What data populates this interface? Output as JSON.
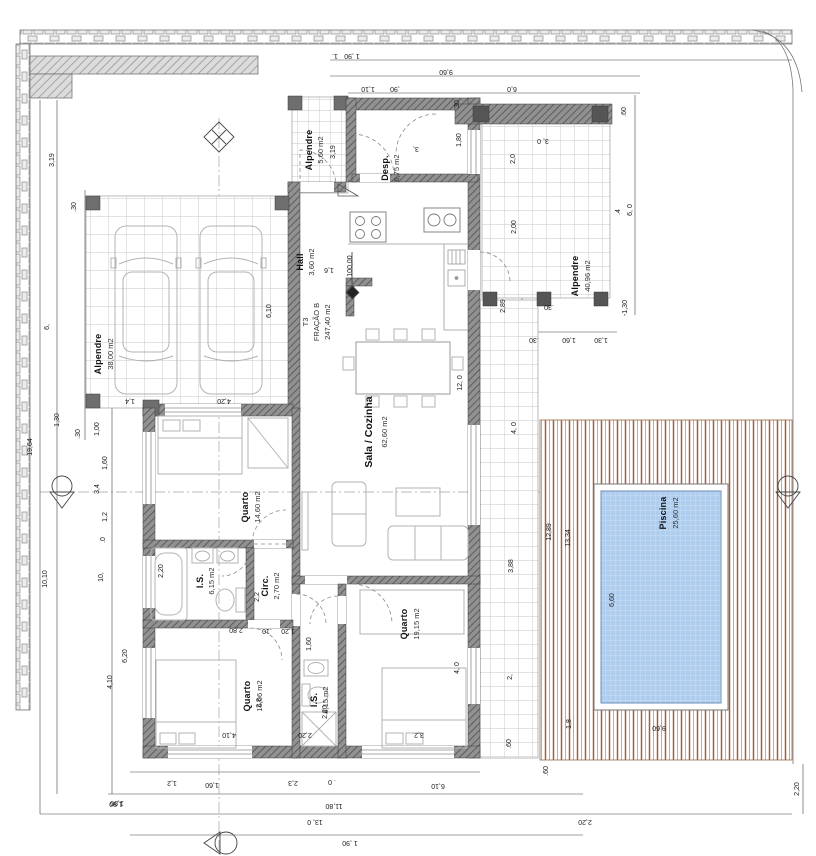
{
  "colors": {
    "wall_base": "#919191",
    "wall_hatch": "#575757",
    "deck_stripe": "#a85c30",
    "deck_stripe_light": "#cf9a6c",
    "pool_water": "#aecdef",
    "pool_grid": "#d3e4f8",
    "tile_line": "#c6c6c6",
    "brick_fill": "#ececec",
    "brick_line": "#8a8a8a"
  },
  "labels": [
    {
      "name": "room-alpendre-top-name",
      "text": "Alpendre",
      "x": 312,
      "y": 150,
      "rot": -90,
      "kind": "room"
    },
    {
      "name": "room-alpendre-top-area",
      "text": "5,60 m2",
      "x": 323,
      "y": 150,
      "rot": -90,
      "kind": "area"
    },
    {
      "name": "dim-alpendre-top",
      "text": "3,19",
      "x": 335,
      "y": 152,
      "rot": -90,
      "kind": "dim"
    },
    {
      "name": "room-desp-name",
      "text": "Desp.",
      "x": 388,
      "y": 168,
      "rot": -90,
      "kind": "room"
    },
    {
      "name": "room-desp-area",
      "text": "6,75 m2",
      "x": 399,
      "y": 168,
      "rot": -90,
      "kind": "area"
    },
    {
      "name": "room-hall-name",
      "text": "Hall",
      "x": 303,
      "y": 262,
      "rot": -90,
      "kind": "room"
    },
    {
      "name": "room-hall-area",
      "text": "3,60 m2",
      "x": 314,
      "y": 262,
      "rot": -90,
      "kind": "area"
    },
    {
      "name": "title-fraction-line1",
      "text": "T3",
      "x": 308,
      "y": 322,
      "rot": -90,
      "kind": "area"
    },
    {
      "name": "title-fraction-line2",
      "text": "FRAÇÃO B",
      "x": 319,
      "y": 322,
      "rot": -90,
      "kind": "area"
    },
    {
      "name": "title-fraction-line3",
      "text": "247,40 m2",
      "x": 330,
      "y": 322,
      "rot": -90,
      "kind": "area"
    },
    {
      "name": "room-sala-name",
      "text": "Sala / Cozinha",
      "x": 372,
      "y": 432,
      "rot": -90,
      "kind": "roomBig"
    },
    {
      "name": "room-sala-area",
      "text": "62,60 m2",
      "x": 387,
      "y": 432,
      "rot": -90,
      "kind": "area"
    },
    {
      "name": "room-garage-name",
      "text": "Alpendre",
      "x": 101,
      "y": 354,
      "rot": -90,
      "kind": "room"
    },
    {
      "name": "room-garage-area",
      "text": "38,00 m2",
      "x": 113,
      "y": 354,
      "rot": -90,
      "kind": "area"
    },
    {
      "name": "room-rporch-name",
      "text": "Alpendre",
      "x": 578,
      "y": 276,
      "rot": -90,
      "kind": "room"
    },
    {
      "name": "room-rporch-area",
      "text": "40,96 m2",
      "x": 590,
      "y": 276,
      "rot": -90,
      "kind": "area"
    },
    {
      "name": "room-quarto1-name",
      "text": "Quarto",
      "x": 248,
      "y": 507,
      "rot": -90,
      "kind": "room"
    },
    {
      "name": "room-quarto1-area",
      "text": "14,60 m2",
      "x": 260,
      "y": 507,
      "rot": -90,
      "kind": "area"
    },
    {
      "name": "room-is1-name",
      "text": "I.S.",
      "x": 203,
      "y": 581,
      "rot": -90,
      "kind": "room"
    },
    {
      "name": "room-is1-area",
      "text": "6,15 m2",
      "x": 214,
      "y": 581,
      "rot": -90,
      "kind": "area"
    },
    {
      "name": "room-circ-name",
      "text": "Circ.",
      "x": 268,
      "y": 586,
      "rot": -90,
      "kind": "room"
    },
    {
      "name": "room-circ-area",
      "text": "2,70 m2",
      "x": 279,
      "y": 586,
      "rot": -90,
      "kind": "area"
    },
    {
      "name": "room-quarto2-name",
      "text": "Quarto",
      "x": 250,
      "y": 696,
      "rot": -90,
      "kind": "room"
    },
    {
      "name": "room-quarto2-area",
      "text": "16,06 m2",
      "x": 262,
      "y": 696,
      "rot": -90,
      "kind": "area"
    },
    {
      "name": "room-is2-name",
      "text": "I.S.",
      "x": 317,
      "y": 700,
      "rot": -90,
      "kind": "room"
    },
    {
      "name": "room-is2-area",
      "text": "6,15 m2",
      "x": 328,
      "y": 700,
      "rot": -90,
      "kind": "area"
    },
    {
      "name": "room-quarto3-name",
      "text": "Quarto",
      "x": 407,
      "y": 624,
      "rot": -90,
      "kind": "room"
    },
    {
      "name": "room-quarto3-area",
      "text": "19,15 m2",
      "x": 419,
      "y": 624,
      "rot": -90,
      "kind": "area"
    },
    {
      "name": "room-piscina-name",
      "text": "Piscina",
      "x": 666,
      "y": 513,
      "rot": -90,
      "kind": "room"
    },
    {
      "name": "room-piscina-area",
      "text": "25,60 m2",
      "x": 678,
      "y": 513,
      "rot": -90,
      "kind": "area"
    },
    {
      "name": "level-value",
      "text": "100,00",
      "x": 352,
      "y": 266,
      "rot": -90,
      "kind": "dim"
    },
    {
      "name": "dim-top-1",
      "text": "1.",
      "x": 335,
      "y": 54,
      "rot": 180,
      "kind": "dim"
    },
    {
      "name": "dim-top-190",
      "text": "1 ,90",
      "x": 352,
      "y": 54,
      "rot": 180,
      "kind": "dim"
    },
    {
      "name": "dim-top-960",
      "text": "9,60",
      "x": 446,
      "y": 70,
      "rot": 180,
      "kind": "dim"
    },
    {
      "name": "dim-top-110",
      "text": "1,10",
      "x": 368,
      "y": 87,
      "rot": 180,
      "kind": "dim"
    },
    {
      "name": "dim-top-90",
      "text": ",90",
      "x": 395,
      "y": 87,
      "rot": 180,
      "kind": "dim"
    },
    {
      "name": "dim-top-60",
      "text": "6,0",
      "x": 512,
      "y": 87,
      "rot": 180,
      "kind": "dim"
    },
    {
      "name": "dim-left-319",
      "text": "3,19",
      "x": 54,
      "y": 160,
      "rot": -90,
      "kind": "dim"
    },
    {
      "name": "dim-left-30a",
      "text": ".30",
      "x": 76,
      "y": 207,
      "rot": -90,
      "kind": "dim"
    },
    {
      "name": "dim-left-6",
      "text": "6,",
      "x": 49,
      "y": 327,
      "rot": -90,
      "kind": "dim"
    },
    {
      "name": "dim-left-1964",
      "text": "19,64",
      "x": 32,
      "y": 447,
      "rot": -90,
      "kind": "dim"
    },
    {
      "name": "dim-left-1010",
      "text": "10,10",
      "x": 47,
      "y": 579,
      "rot": -90,
      "kind": "dim"
    },
    {
      "name": "dim-left-10",
      "text": "10,",
      "x": 103,
      "y": 577,
      "rot": -90,
      "kind": "dim"
    },
    {
      "name": "dim-left-130",
      "text": "1,30",
      "x": 59,
      "y": 420,
      "rot": -90,
      "kind": "dim"
    },
    {
      "name": "dim-left-30b",
      "text": ".30",
      "x": 80,
      "y": 434,
      "rot": -90,
      "kind": "dim"
    },
    {
      "name": "dim-left-100",
      "text": "1,00",
      "x": 99,
      "y": 429,
      "rot": -90,
      "kind": "dim"
    },
    {
      "name": "dim-left-160",
      "text": "1,60",
      "x": 107,
      "y": 463,
      "rot": -90,
      "kind": "dim"
    },
    {
      "name": "dim-left-34",
      "text": "3,4",
      "x": 99,
      "y": 489,
      "rot": -90,
      "kind": "dim"
    },
    {
      "name": "dim-left-12",
      "text": "1,2",
      "x": 107,
      "y": 517,
      "rot": -90,
      "kind": "dim"
    },
    {
      "name": "dim-left-0",
      "text": ".0",
      "x": 105,
      "y": 540,
      "rot": -90,
      "kind": "dim"
    },
    {
      "name": "dim-left-620",
      "text": "6,20",
      "x": 127,
      "y": 656,
      "rot": -90,
      "kind": "dim"
    },
    {
      "name": "dim-left-410",
      "text": "4,10",
      "x": 112,
      "y": 682,
      "rot": -90,
      "kind": "dim"
    },
    {
      "name": "dim-left-190",
      "text": "1,90",
      "x": 117,
      "y": 801,
      "rot": 180,
      "kind": "dim"
    },
    {
      "name": "dim-garage-14",
      "text": "1,4",
      "x": 130,
      "y": 399,
      "rot": 180,
      "kind": "dim"
    },
    {
      "name": "dim-garage-420",
      "text": "4,20",
      "x": 224,
      "y": 399,
      "rot": 180,
      "kind": "dim"
    },
    {
      "name": "dim-garage-610",
      "text": "6,10",
      "x": 271,
      "y": 311,
      "rot": -90,
      "kind": "dim"
    },
    {
      "name": "dim-hall-16",
      "text": "1,6",
      "x": 329,
      "y": 268,
      "rot": 180,
      "kind": "dim"
    },
    {
      "name": "dim-sala-120",
      "text": "12, 0",
      "x": 462,
      "y": 383,
      "rot": -90,
      "kind": "dim"
    },
    {
      "name": "dim-desp-180",
      "text": "1,80",
      "x": 461,
      "y": 140,
      "rot": -90,
      "kind": "dim"
    },
    {
      "name": "dim-desp-3",
      "text": "3,",
      "x": 416,
      "y": 147,
      "rot": 180,
      "kind": "dim"
    },
    {
      "name": "dim-tub-220",
      "text": "2,20",
      "x": 163,
      "y": 571,
      "rot": -90,
      "kind": "dim"
    },
    {
      "name": "dim-circ-22",
      "text": "2,2",
      "x": 259,
      "y": 597,
      "rot": -90,
      "kind": "dim"
    },
    {
      "name": "dim-mid-280",
      "text": "2,80",
      "x": 236,
      "y": 628,
      "rot": 180,
      "kind": "dim"
    },
    {
      "name": "dim-mid-10",
      "text": ".10",
      "x": 267,
      "y": 629,
      "rot": 180,
      "kind": "dim"
    },
    {
      "name": "dim-mid-120",
      "text": "1,20",
      "x": 288,
      "y": 629,
      "rot": 180,
      "kind": "dim"
    },
    {
      "name": "dim-q2-28",
      "text": "2,8",
      "x": 261,
      "y": 703,
      "rot": -90,
      "kind": "dim"
    },
    {
      "name": "dim-is2-220",
      "text": "2,20",
      "x": 327,
      "y": 712,
      "rot": -90,
      "kind": "dim"
    },
    {
      "name": "dim-is2-160",
      "text": "1,60",
      "x": 311,
      "y": 644,
      "rot": -90,
      "kind": "dim"
    },
    {
      "name": "dim-bot-410",
      "text": "4,10",
      "x": 229,
      "y": 733,
      "rot": 180,
      "kind": "dim"
    },
    {
      "name": "dim-bot-220",
      "text": "2,20",
      "x": 305,
      "y": 733,
      "rot": 180,
      "kind": "dim"
    },
    {
      "name": "dim-bot-32",
      "text": "3,2",
      "x": 419,
      "y": 733,
      "rot": 180,
      "kind": "dim"
    },
    {
      "name": "dim-q3-40",
      "text": "4, 0",
      "x": 459,
      "y": 668,
      "rot": -90,
      "kind": "dim"
    },
    {
      "name": "dim-wing-30a",
      "text": ".30",
      "x": 459,
      "y": 105,
      "rot": -90,
      "kind": "dim"
    },
    {
      "name": "dim-wing-30b",
      "text": "3, 0",
      "x": 543,
      "y": 139,
      "rot": 180,
      "kind": "dim"
    },
    {
      "name": "dim-wing-20",
      "text": "2,0",
      "x": 515,
      "y": 159,
      "rot": -90,
      "kind": "dim"
    },
    {
      "name": "dim-wing-200",
      "text": "2,00",
      "x": 516,
      "y": 227,
      "rot": -90,
      "kind": "dim"
    },
    {
      "name": "dim-wing-289",
      "text": "2,89",
      "x": 505,
      "y": 306,
      "rot": -90,
      "kind": "dim"
    },
    {
      "name": "dim-wing-30c",
      "text": ".30",
      "x": 549,
      "y": 305,
      "rot": 180,
      "kind": "dim"
    },
    {
      "name": "dim-wing-60a",
      "text": ".60",
      "x": 626,
      "y": 112,
      "rot": -90,
      "kind": "dim"
    },
    {
      "name": "dim-wing-6_0",
      "text": "6, 0",
      "x": 632,
      "y": 210,
      "rot": -90,
      "kind": "dim"
    },
    {
      "name": "dim-wing-4",
      "text": ".4",
      "x": 620,
      "y": 212,
      "rot": -90,
      "kind": "dim"
    },
    {
      "name": "dim-wing-m130",
      "text": "-1,30",
      "x": 627,
      "y": 308,
      "rot": -90,
      "kind": "dim"
    },
    {
      "name": "dim-row-30",
      "text": ".30",
      "x": 534,
      "y": 338,
      "rot": 180,
      "kind": "dim"
    },
    {
      "name": "dim-row-160",
      "text": "1,60",
      "x": 569,
      "y": 338,
      "rot": 180,
      "kind": "dim"
    },
    {
      "name": "dim-row-130",
      "text": "1,30",
      "x": 601,
      "y": 338,
      "rot": 180,
      "kind": "dim"
    },
    {
      "name": "dim-right-40",
      "text": "4, 0",
      "x": 516,
      "y": 428,
      "rot": -90,
      "kind": "dim"
    },
    {
      "name": "dim-right-388",
      "text": "3,88",
      "x": 513,
      "y": 566,
      "rot": -90,
      "kind": "dim"
    },
    {
      "name": "dim-right-2",
      "text": "2,",
      "x": 512,
      "y": 677,
      "rot": -90,
      "kind": "dim"
    },
    {
      "name": "dim-right-1289",
      "text": "12,89",
      "x": 551,
      "y": 532,
      "rot": -90,
      "kind": "dim"
    },
    {
      "name": "dim-right-1334",
      "text": "13,34",
      "x": 570,
      "y": 538,
      "rot": -90,
      "kind": "dim"
    },
    {
      "name": "dim-pool-660",
      "text": "6,60",
      "x": 614,
      "y": 600,
      "rot": -90,
      "kind": "dim"
    },
    {
      "name": "dim-pool-960",
      "text": "9,60",
      "x": 659,
      "y": 726,
      "rot": 180,
      "kind": "dim"
    },
    {
      "name": "dim-br-60a",
      "text": ".60",
      "x": 511,
      "y": 744,
      "rot": -90,
      "kind": "dim"
    },
    {
      "name": "dim-br-18",
      "text": "1,8",
      "x": 571,
      "y": 724,
      "rot": -90,
      "kind": "dim"
    },
    {
      "name": "dim-br-60b",
      "text": ".60",
      "x": 548,
      "y": 771,
      "rot": -90,
      "kind": "dim"
    },
    {
      "name": "dim-br-220a",
      "text": "2,20",
      "x": 585,
      "y": 820,
      "rot": 180,
      "kind": "dim"
    },
    {
      "name": "dim-br-220b",
      "text": "2,20",
      "x": 799,
      "y": 789,
      "rot": -90,
      "kind": "dim"
    },
    {
      "name": "dim-bot2-12",
      "text": "1,2",
      "x": 172,
      "y": 781,
      "rot": 180,
      "kind": "dim"
    },
    {
      "name": "dim-bot2-160",
      "text": "1,60",
      "x": 212,
      "y": 783,
      "rot": 180,
      "kind": "dim"
    },
    {
      "name": "dim-bot2-23",
      "text": "2,3",
      "x": 293,
      "y": 781,
      "rot": 180,
      "kind": "dim"
    },
    {
      "name": "dim-bot2-0",
      "text": ". 0",
      "x": 332,
      "y": 780,
      "rot": 180,
      "kind": "dim"
    },
    {
      "name": "dim-bot2-610",
      "text": "6,10",
      "x": 438,
      "y": 784,
      "rot": 180,
      "kind": "dim"
    },
    {
      "name": "dim-bot3-190",
      "text": "1,90",
      "x": 116,
      "y": 802,
      "rot": 180,
      "kind": "dim"
    },
    {
      "name": "dim-bot3-1180",
      "text": "11,80",
      "x": 334,
      "y": 804,
      "rot": 180,
      "kind": "dim"
    },
    {
      "name": "dim-bot4-130",
      "text": "13, 0",
      "x": 315,
      "y": 820,
      "rot": 180,
      "kind": "dim"
    },
    {
      "name": "dim-bot5-190",
      "text": "1 ,90",
      "x": 350,
      "y": 841,
      "rot": 180,
      "kind": "dim"
    }
  ]
}
